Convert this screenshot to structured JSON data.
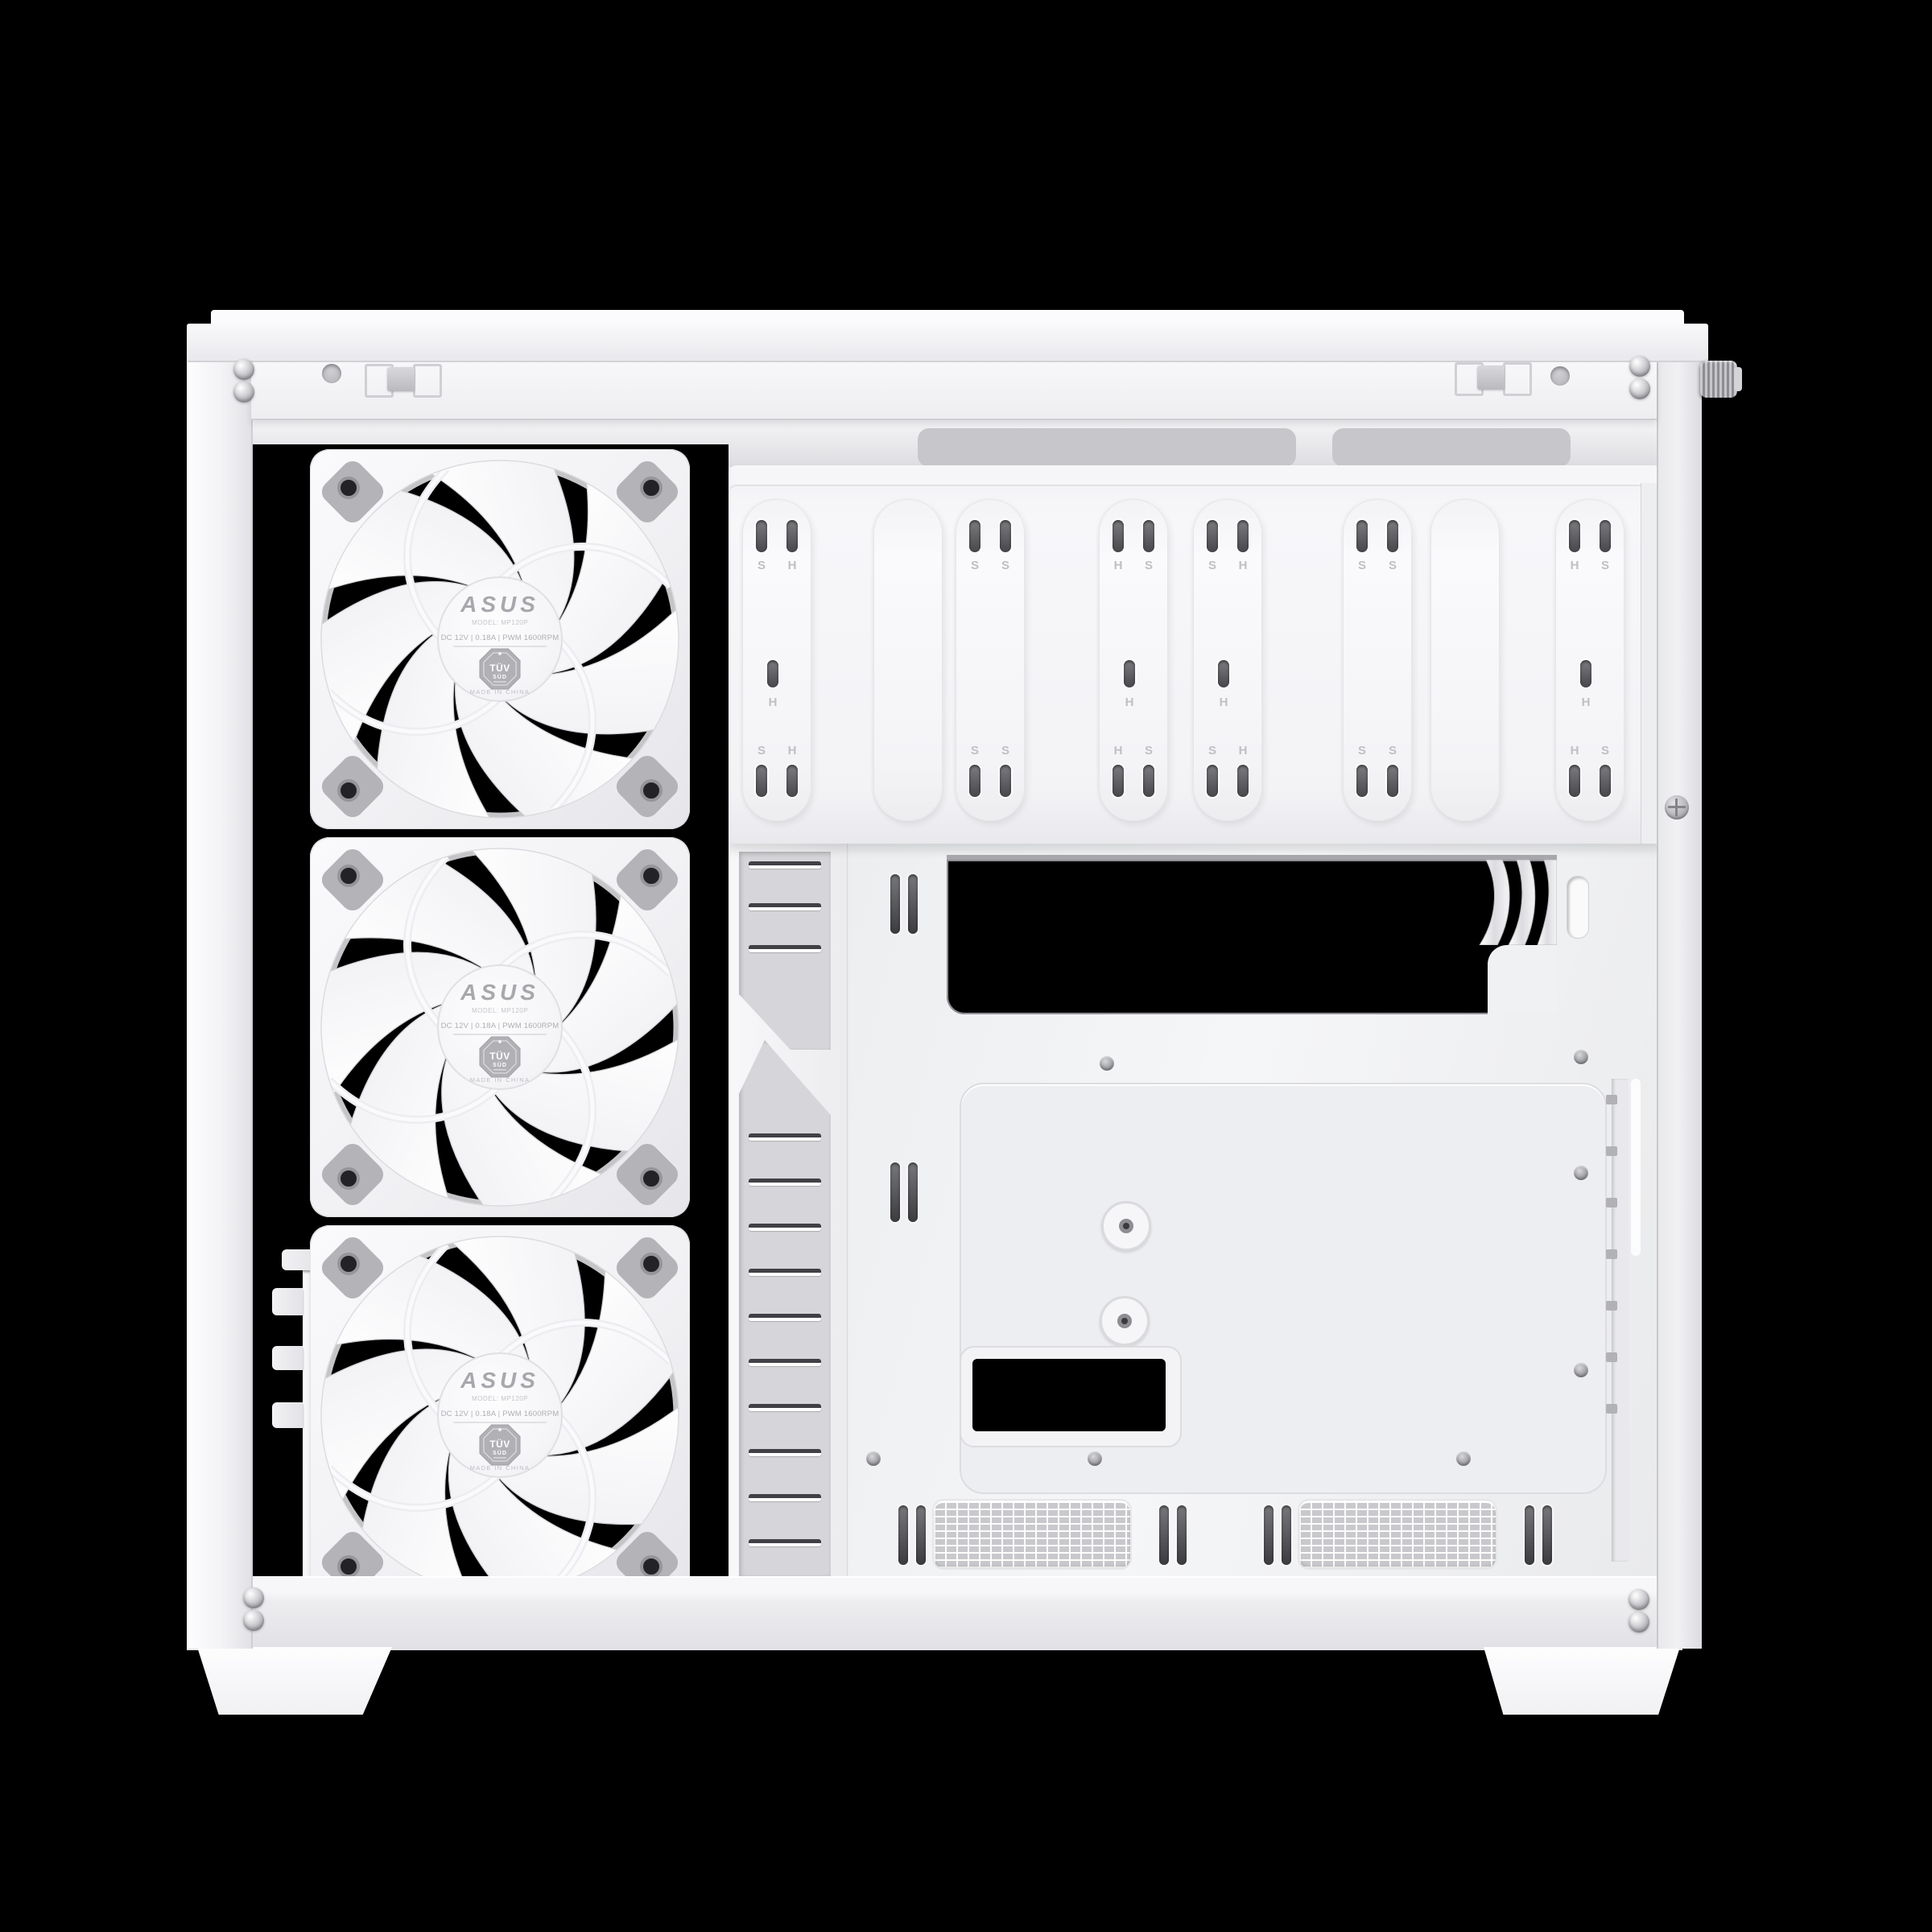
{
  "scene": {
    "subject": "White ATX PC case interior, side panel removed",
    "background": "#000000"
  },
  "colors": {
    "case_white": "#f2f2f5",
    "panel_shadow": "#dfdfe3",
    "recess_gray": "#b6b6ba",
    "slot_dark": "#47474c",
    "background": "#000000"
  },
  "fan": {
    "count": 3,
    "brand": "ASUS",
    "model": "MODEL: MP120P",
    "spec": "DC 12V | 0.18A | PWM 1600RPM",
    "cert_line1": "TÜV",
    "cert_line2": "SÜD",
    "origin": "MADE IN CHINA"
  },
  "bracket": {
    "rails": [
      {
        "holes": true,
        "top": [
          "S",
          "H"
        ],
        "middle": "H",
        "middle_hole": true,
        "bottom": [
          "S",
          "H"
        ]
      },
      {
        "holes": false,
        "top": [],
        "middle": "",
        "middle_hole": false,
        "bottom": []
      },
      {
        "holes": true,
        "top": [
          "S",
          "S"
        ],
        "middle": "",
        "middle_hole": false,
        "bottom": [
          "S",
          "S"
        ]
      },
      {
        "holes": true,
        "top": [
          "H",
          "S"
        ],
        "middle": "H",
        "middle_hole": true,
        "bottom": [
          "H",
          "S"
        ]
      },
      {
        "holes": true,
        "top": [
          "S",
          "H"
        ],
        "middle": "H",
        "middle_hole": true,
        "bottom": [
          "S",
          "H"
        ]
      },
      {
        "holes": true,
        "top": [
          "S",
          "S"
        ],
        "middle": "",
        "middle_hole": false,
        "bottom": [
          "S",
          "S"
        ]
      },
      {
        "holes": false,
        "top": [],
        "middle": "",
        "middle_hole": false,
        "bottom": []
      },
      {
        "holes": true,
        "top": [
          "H",
          "S"
        ],
        "middle": "H",
        "middle_hole": true,
        "bottom": [
          "H",
          "S"
        ]
      }
    ]
  }
}
